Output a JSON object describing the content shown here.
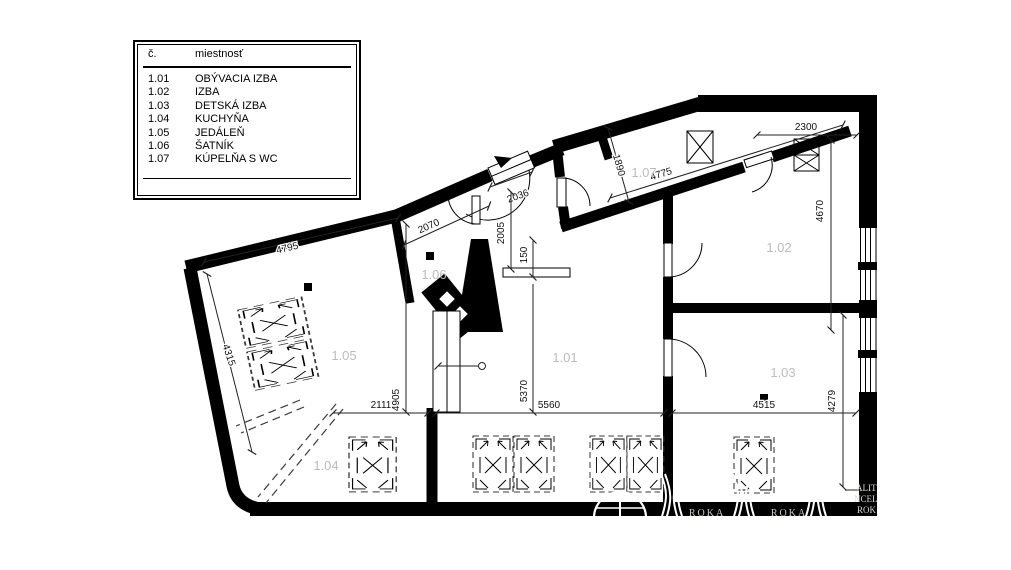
{
  "legend": {
    "header": {
      "no": "č.",
      "name": "miestnosť"
    },
    "rows": [
      {
        "no": "1.01",
        "name": "OBÝVACIA IZBA"
      },
      {
        "no": "1.02",
        "name": "IZBA"
      },
      {
        "no": "1.03",
        "name": "DETSKÁ IZBA"
      },
      {
        "no": "1.04",
        "name": "KUCHYŇA"
      },
      {
        "no": "1.05",
        "name": "JEDÁLEŇ"
      },
      {
        "no": "1.06",
        "name": "ŠATNÍK"
      },
      {
        "no": "1.07",
        "name": "KÚPELŇA S WC"
      }
    ]
  },
  "plan": {
    "room_labels": {
      "r101": "1.01",
      "r102": "1.02",
      "r103": "1.03",
      "r104": "1.04",
      "r105": "1.05",
      "r106": "1.06",
      "r107": "1.07"
    },
    "dimensions": {
      "d4795": "4795",
      "d4315": "4315",
      "d2070": "2070",
      "d2005": "2005",
      "d150": "150",
      "d2036": "2036",
      "d1890": "1890",
      "d4775": "4775",
      "d2300": "2300",
      "d4670": "4670",
      "d2111": "2111",
      "d4905": "4905",
      "d5370": "5370",
      "d5560": "5560",
      "d4515": "4515",
      "d4279": "4279"
    },
    "watermarks": {
      "roka": "ROKA",
      "fragment_1": "ALIT",
      "fragment_2": "NCEL",
      "fragment_3": "ROK"
    }
  },
  "colors": {
    "wall": "#000000",
    "background": "#ffffff",
    "room_label": "#bcbcbc",
    "dim_text": "#111111",
    "watermark": "#c9c9bd"
  }
}
